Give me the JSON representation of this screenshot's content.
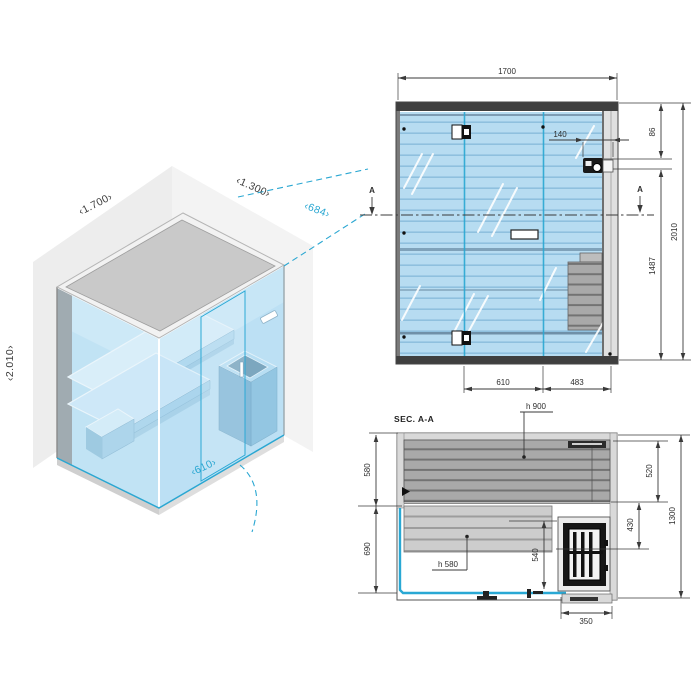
{
  "page": {
    "background": "#ffffff"
  },
  "colors": {
    "accent_cyan": "#29a8d4",
    "glass_blue": "#b7dcf1",
    "slat_line_blue": "#8fc0de",
    "frame_dark": "#3f3f3f",
    "wall_gray": "#d9d9d9",
    "bench_gray_dark": "#a9a9a9",
    "bench_gray_light": "#cdcdcd",
    "heater_black": "#161616",
    "dim_ink": "#2e2e2e"
  },
  "isometric": {
    "width_label": "‹1.700›",
    "depth_label": "‹1.300›",
    "height_label": "‹2.010›",
    "door_width_label": "‹610›",
    "door_projection_label": "‹684›"
  },
  "front_elevation": {
    "dim_total_width": "1700",
    "dim_control_offset": "140",
    "dim_control_from_top": "86",
    "dim_total_height": "2010",
    "dim_lower_height": "1487",
    "dim_door_width": "610",
    "dim_side_panel": "483",
    "section_marker_left": "A",
    "section_marker_right": "A"
  },
  "section_plan": {
    "title": "SEC. A-A",
    "upper_bench_height_label": "h 900",
    "lower_bench_height_label": "h 580",
    "dim_back_zone": "580",
    "dim_front_zone": "690",
    "dim_upper_bench_depth": "520",
    "dim_lower_bench_depth": "430",
    "dim_total_depth": "1300",
    "dim_front_clear": "540",
    "dim_heater_width": "350"
  }
}
